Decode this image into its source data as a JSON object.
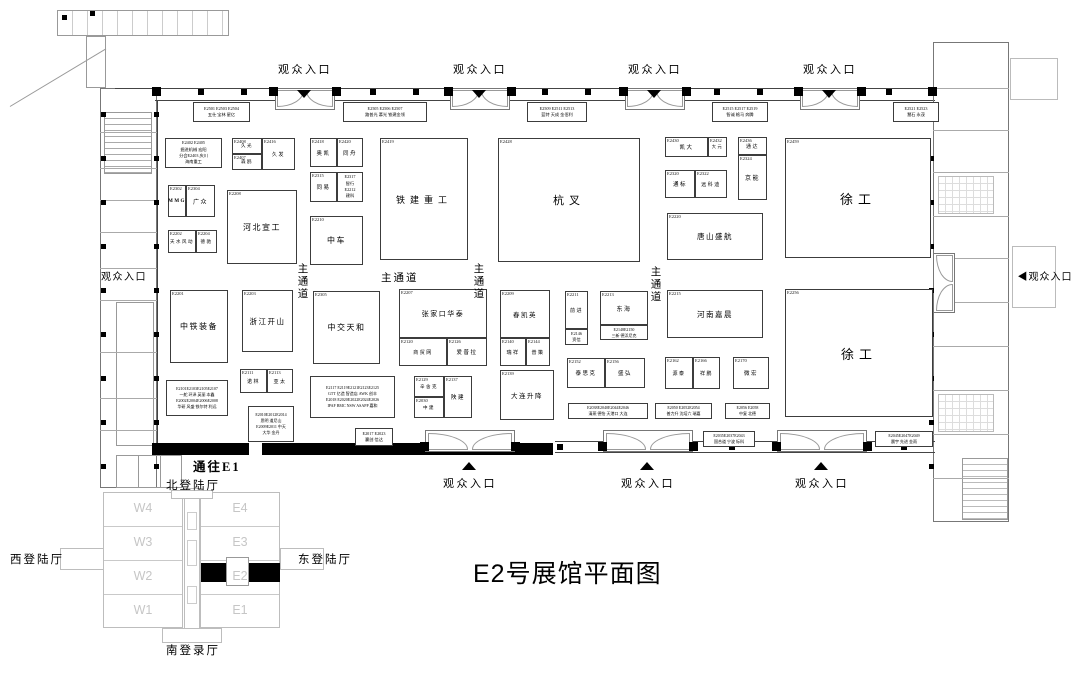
{
  "title": "E2号展馆平面图",
  "to_e1_label": "通往E1",
  "entrances": {
    "label": "观众入口",
    "right_label": "◀观众入口",
    "top_x": [
      305,
      480,
      655,
      830
    ],
    "bottom_x": [
      470,
      648,
      822
    ],
    "left": {
      "x": 94,
      "y": 268
    },
    "right": {
      "x": 1008,
      "y": 268
    }
  },
  "main_aisles": [
    {
      "text": "主通道",
      "x": 296,
      "y": 263,
      "vertical": true
    },
    {
      "text": "主通道",
      "x": 381,
      "y": 270,
      "vertical": false
    },
    {
      "text": "主通道",
      "x": 472,
      "y": 263,
      "vertical": true
    },
    {
      "text": "主通道",
      "x": 649,
      "y": 266,
      "vertical": true
    }
  ],
  "minimap": {
    "north_label": "北登陆厅",
    "south_label": "南登录厅",
    "west_label": "西登陆厅",
    "east_label": "东登陆厅",
    "west_halls": [
      "W4",
      "W3",
      "W2",
      "W1"
    ],
    "east_halls": [
      "E4",
      "E3",
      "E2",
      "E1"
    ],
    "highlighted_hall": "E2"
  },
  "booths": [
    {
      "x": 193,
      "y": 102,
      "w": 57,
      "h": 20,
      "lines": [
        "E2501 E2503 E2504",
        "五仕 宝林 星亿"
      ],
      "fs": 4.2
    },
    {
      "x": 343,
      "y": 102,
      "w": 84,
      "h": 20,
      "lines": [
        "E2505 E2506 E2507",
        "路普光 慕光 铁建金领"
      ],
      "fs": 4.2
    },
    {
      "x": 527,
      "y": 102,
      "w": 60,
      "h": 20,
      "lines": [
        "E2509 E2511 E2513",
        "蓝特 天成 金佰利"
      ],
      "fs": 4.2
    },
    {
      "x": 712,
      "y": 102,
      "w": 56,
      "h": 20,
      "lines": [
        "E2515 E2517 E2519",
        "智诚 格马 奔腾"
      ],
      "fs": 4.2
    },
    {
      "x": 893,
      "y": 102,
      "w": 46,
      "h": 20,
      "lines": [
        "E2521 E2523",
        "慧石 永茂"
      ],
      "fs": 4.2
    },
    {
      "x": 165,
      "y": 138,
      "w": 57,
      "h": 30,
      "lines": [
        "E2402 E2405",
        "掘进机械 宏阳",
        "分会E2403 庆川",
        "海南重工"
      ],
      "fs": 4.2
    },
    {
      "x": 168,
      "y": 185,
      "w": 18,
      "h": 32,
      "num": "E2302",
      "name": "MMG",
      "fs": 5,
      "bold": true
    },
    {
      "x": 186,
      "y": 185,
      "w": 29,
      "h": 32,
      "num": "E2304",
      "name": "广众",
      "fs": 6
    },
    {
      "x": 168,
      "y": 230,
      "w": 28,
      "h": 23,
      "num": "E2202",
      "name": "天水风动",
      "fs": 4.5
    },
    {
      "x": 196,
      "y": 230,
      "w": 21,
      "h": 23,
      "num": "E2204",
      "name": "德驰",
      "fs": 4.5
    },
    {
      "x": 170,
      "y": 290,
      "w": 58,
      "h": 73,
      "num": "E2201",
      "name": "中铁装备",
      "fs": 8
    },
    {
      "x": 166,
      "y": 380,
      "w": 62,
      "h": 36,
      "lines": [
        "E2101E2103E2105E2107",
        "一舵 环泽 英丽 本鑫",
        "E2002E2004E2006E2008",
        "华研 风盛 铁尔特 利远"
      ],
      "fs": 4
    },
    {
      "x": 232,
      "y": 138,
      "w": 30,
      "h": 16,
      "num": "E2408",
      "name": "久光",
      "fs": 4.5
    },
    {
      "x": 262,
      "y": 138,
      "w": 33,
      "h": 32,
      "num": "E2416",
      "name": "久发",
      "fs": 5
    },
    {
      "x": 232,
      "y": 154,
      "w": 30,
      "h": 16,
      "num": "E2407",
      "name": "森鸥",
      "fs": 4.5
    },
    {
      "x": 227,
      "y": 190,
      "w": 70,
      "h": 74,
      "num": "E2208",
      "name": "河北宣工",
      "fs": 8
    },
    {
      "x": 242,
      "y": 290,
      "w": 51,
      "h": 62,
      "num": "E2203",
      "name": "浙江开山",
      "fs": 7.5
    },
    {
      "x": 240,
      "y": 369,
      "w": 27,
      "h": 24,
      "num": "E2111",
      "name": "诺林",
      "fs": 5
    },
    {
      "x": 267,
      "y": 369,
      "w": 26,
      "h": 24,
      "num": "E2113",
      "name": "亚太",
      "fs": 5
    },
    {
      "x": 248,
      "y": 406,
      "w": 46,
      "h": 36,
      "lines": [
        "E2010E2012E2014",
        "思明 道尼山",
        "E2009E2011 中天",
        "大华 金丹"
      ],
      "fs": 4
    },
    {
      "x": 310,
      "y": 138,
      "w": 27,
      "h": 29,
      "num": "E2418",
      "name": "奥凯",
      "fs": 5.5
    },
    {
      "x": 337,
      "y": 138,
      "w": 26,
      "h": 29,
      "num": "E2420",
      "name": "同舟",
      "fs": 5.5
    },
    {
      "x": 310,
      "y": 172,
      "w": 27,
      "h": 30,
      "num": "E2315",
      "name": "同易",
      "fs": 5.5
    },
    {
      "x": 337,
      "y": 172,
      "w": 26,
      "h": 30,
      "lines": [
        "E2317",
        "智行",
        "E2212",
        "建科"
      ],
      "fs": 4.2
    },
    {
      "x": 310,
      "y": 216,
      "w": 53,
      "h": 49,
      "num": "E2210",
      "name": "中车",
      "fs": 8
    },
    {
      "x": 313,
      "y": 291,
      "w": 67,
      "h": 73,
      "num": "E2305",
      "name": "中交天和",
      "fs": 8
    },
    {
      "x": 310,
      "y": 376,
      "w": 85,
      "h": 42,
      "lines": [
        "E2117 E2119E2121E2123E2125",
        "GTT 亿造 智造店 AWK 创丰",
        "E2018 E2020E2022E2024E2026",
        "IPAF BMC NSW ASAPP 嘉和"
      ],
      "fs": 4
    },
    {
      "x": 355,
      "y": 428,
      "w": 38,
      "h": 18,
      "lines": [
        "E2017 E2023",
        "赢创 信达"
      ],
      "fs": 4.2
    },
    {
      "x": 380,
      "y": 138,
      "w": 88,
      "h": 122,
      "num": "E2419",
      "name": "铁建重工",
      "fs": 9
    },
    {
      "x": 399,
      "y": 289,
      "w": 88,
      "h": 49,
      "num": "E2207",
      "name": "张家口华泰",
      "fs": 7
    },
    {
      "x": 399,
      "y": 338,
      "w": 48,
      "h": 28,
      "num": "E2120",
      "name": "商贸网",
      "fs": 5
    },
    {
      "x": 447,
      "y": 338,
      "w": 40,
      "h": 28,
      "num": "E2126",
      "name": "爱普拉",
      "fs": 5.5
    },
    {
      "x": 414,
      "y": 376,
      "w": 30,
      "h": 21,
      "num": "E2129",
      "name": "辛舍克",
      "fs": 4.5
    },
    {
      "x": 414,
      "y": 397,
      "w": 30,
      "h": 21,
      "num": "E2030",
      "name": "中建",
      "fs": 4.5
    },
    {
      "x": 444,
      "y": 376,
      "w": 28,
      "h": 42,
      "num": "E2137",
      "name": "陕建",
      "fs": 5.5
    },
    {
      "x": 498,
      "y": 138,
      "w": 142,
      "h": 124,
      "num": "E2428",
      "name": "杭叉",
      "fs": 11
    },
    {
      "x": 500,
      "y": 290,
      "w": 50,
      "h": 48,
      "num": "E2209",
      "name": "春凯英",
      "fs": 6.5
    },
    {
      "x": 500,
      "y": 338,
      "w": 26,
      "h": 28,
      "num": "E2140",
      "name": "瑞祥",
      "fs": 5
    },
    {
      "x": 526,
      "y": 338,
      "w": 24,
      "h": 28,
      "num": "E2144",
      "name": "普策",
      "fs": 5
    },
    {
      "x": 500,
      "y": 370,
      "w": 54,
      "h": 50,
      "num": "E2139",
      "name": "大连升降",
      "fs": 6.5
    },
    {
      "x": 565,
      "y": 291,
      "w": 23,
      "h": 38,
      "num": "E2211",
      "name": "前进",
      "fs": 5
    },
    {
      "x": 565,
      "y": 329,
      "w": 23,
      "h": 16,
      "lines": [
        "E2146",
        "资信"
      ],
      "fs": 4.2
    },
    {
      "x": 600,
      "y": 291,
      "w": 48,
      "h": 34,
      "num": "E2213",
      "name": "东海",
      "fs": 6
    },
    {
      "x": 600,
      "y": 325,
      "w": 48,
      "h": 15,
      "lines": [
        "E2148E2150",
        "三新 德浜尼克"
      ],
      "fs": 4
    },
    {
      "x": 567,
      "y": 358,
      "w": 38,
      "h": 30,
      "num": "E2152",
      "name": "泰思克",
      "fs": 5.5
    },
    {
      "x": 605,
      "y": 358,
      "w": 40,
      "h": 30,
      "num": "E2156",
      "name": "盛弘",
      "fs": 5.5
    },
    {
      "x": 568,
      "y": 403,
      "w": 80,
      "h": 16,
      "lines": [
        "E2038E2040E2044E2046",
        "清燕 德怡 天港口 大连"
      ],
      "fs": 4
    },
    {
      "x": 655,
      "y": 403,
      "w": 57,
      "h": 16,
      "lines": [
        "E2050 E2052E2054",
        "普力升 沈培六 瑞嘉"
      ],
      "fs": 4
    },
    {
      "x": 725,
      "y": 403,
      "w": 45,
      "h": 16,
      "lines": [
        "E2056 E2058",
        "中复 北德"
      ],
      "fs": 4
    },
    {
      "x": 703,
      "y": 431,
      "w": 52,
      "h": 16,
      "lines": [
        "E2035E2037E2043",
        "国合道 宁波 标科"
      ],
      "fs": 4
    },
    {
      "x": 875,
      "y": 431,
      "w": 58,
      "h": 16,
      "lines": [
        "E2045E2047E2049",
        "晨宇 先进 金雨"
      ],
      "fs": 4
    },
    {
      "x": 665,
      "y": 137,
      "w": 43,
      "h": 20,
      "num": "E2430",
      "name": "凯大",
      "fs": 5.5
    },
    {
      "x": 708,
      "y": 137,
      "w": 19,
      "h": 20,
      "num": "E2432",
      "name": "大元",
      "fs": 4.2
    },
    {
      "x": 738,
      "y": 137,
      "w": 29,
      "h": 18,
      "num": "E2436",
      "name": "通达",
      "fs": 5
    },
    {
      "x": 738,
      "y": 155,
      "w": 29,
      "h": 45,
      "num": "E2324",
      "name": "京能",
      "fs": 6
    },
    {
      "x": 665,
      "y": 170,
      "w": 30,
      "h": 28,
      "num": "E2320",
      "name": "通标",
      "fs": 5.5
    },
    {
      "x": 695,
      "y": 170,
      "w": 32,
      "h": 28,
      "num": "E2322",
      "name": "远科迪",
      "fs": 5
    },
    {
      "x": 667,
      "y": 213,
      "w": 96,
      "h": 47,
      "num": "E2220",
      "name": "唐山盛航",
      "fs": 7.5
    },
    {
      "x": 785,
      "y": 138,
      "w": 146,
      "h": 120,
      "num": "E2459",
      "name": "徐工",
      "fs": 13
    },
    {
      "x": 667,
      "y": 290,
      "w": 96,
      "h": 48,
      "num": "E2215",
      "name": "河南嘉晨",
      "fs": 7.5
    },
    {
      "x": 665,
      "y": 357,
      "w": 28,
      "h": 32,
      "num": "E2162",
      "name": "源泰",
      "fs": 5
    },
    {
      "x": 693,
      "y": 357,
      "w": 27,
      "h": 32,
      "num": "E2166",
      "name": "祥鹏",
      "fs": 5
    },
    {
      "x": 733,
      "y": 357,
      "w": 36,
      "h": 32,
      "num": "E2170",
      "name": "微宏",
      "fs": 5.5
    },
    {
      "x": 785,
      "y": 289,
      "w": 148,
      "h": 128,
      "num": "E2256",
      "name": "徐工",
      "fs": 13
    }
  ]
}
